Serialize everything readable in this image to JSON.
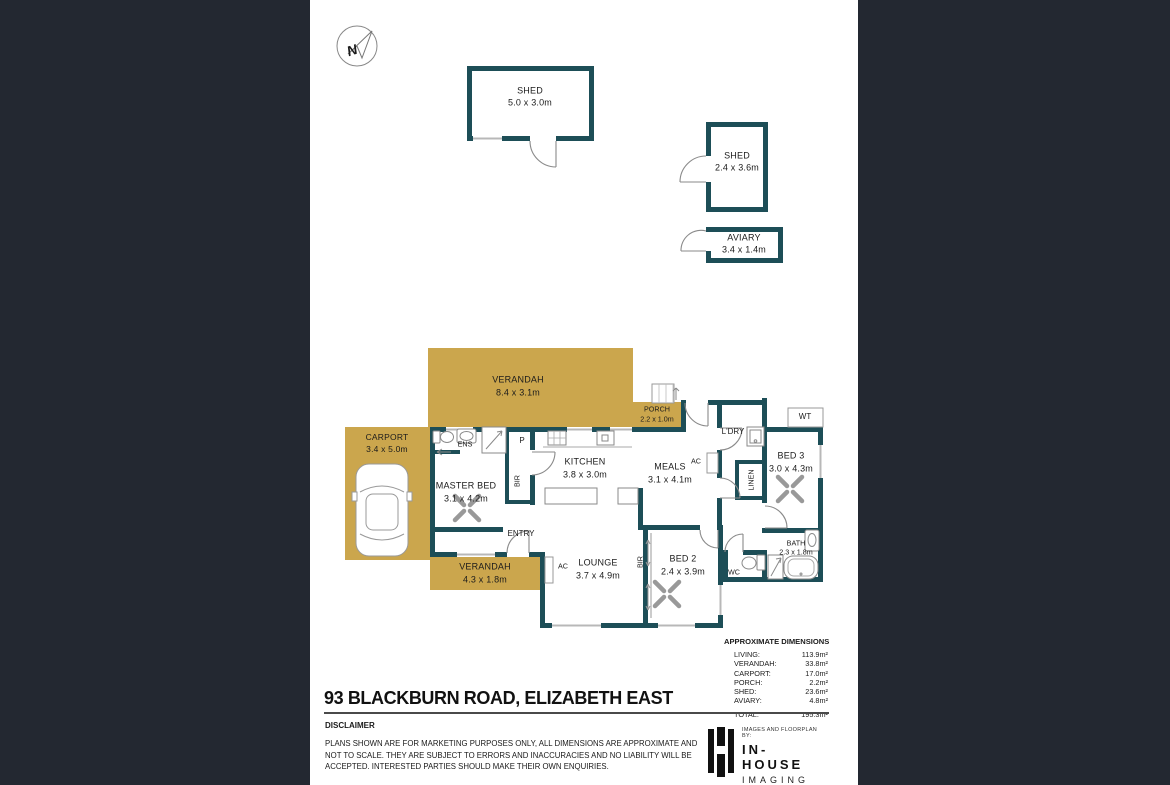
{
  "colors": {
    "background": "#232831",
    "paper": "#ffffff",
    "wall": "#1d4e57",
    "outdoor_gold": "#cba64d"
  },
  "compass": {
    "label": "N"
  },
  "outbuildings": {
    "shed_large": {
      "name": "SHED",
      "dims": "5.0 x 3.0m"
    },
    "shed_small": {
      "name": "SHED",
      "dims": "2.4 x 3.6m"
    },
    "aviary": {
      "name": "AVIARY",
      "dims": "3.4 x 1.4m"
    }
  },
  "rooms": {
    "verandah_top": {
      "name": "VERANDAH",
      "dims": "8.4 x 3.1m"
    },
    "porch": {
      "name": "PORCH",
      "dims": "2.2 x 1.0m"
    },
    "carport": {
      "name": "CARPORT",
      "dims": "3.4 x 5.0m"
    },
    "master_bed": {
      "name": "MASTER BED",
      "dims": "3.1 x 4.2m"
    },
    "ens": {
      "name": "ENS"
    },
    "pantry": {
      "name": "P"
    },
    "bir_master": {
      "name": "BIR"
    },
    "kitchen": {
      "name": "KITCHEN",
      "dims": "3.8 x 3.0m"
    },
    "meals": {
      "name": "MEALS",
      "dims": "3.1 x 4.1m"
    },
    "ac_meals": {
      "name": "AC"
    },
    "ldry": {
      "name": "L'DRY"
    },
    "linen": {
      "name": "LINEN"
    },
    "bed3": {
      "name": "BED 3",
      "dims": "3.0 x 4.3m"
    },
    "wt": {
      "name": "WT"
    },
    "entry": {
      "name": "ENTRY"
    },
    "verandah_bottom": {
      "name": "VERANDAH",
      "dims": "4.3 x 1.8m"
    },
    "ac_lounge": {
      "name": "AC"
    },
    "lounge": {
      "name": "LOUNGE",
      "dims": "3.7 x 4.9m"
    },
    "bir_bed2": {
      "name": "BIR"
    },
    "bed2": {
      "name": "BED 2",
      "dims": "2.4 x 3.9m"
    },
    "wc": {
      "name": "WC"
    },
    "bath": {
      "name": "BATH",
      "dims": "2.3 x 1.8m"
    }
  },
  "summary": {
    "title": "APPROXIMATE DIMENSIONS",
    "rows": [
      {
        "label": "LIVING:",
        "value": "113.9m²"
      },
      {
        "label": "VERANDAH:",
        "value": "33.8m²"
      },
      {
        "label": "CARPORT:",
        "value": "17.0m²"
      },
      {
        "label": "PORCH:",
        "value": "2.2m²"
      },
      {
        "label": "SHED:",
        "value": "23.6m²"
      },
      {
        "label": "AVIARY:",
        "value": "4.8m²"
      }
    ],
    "total": {
      "label": "TOTAL:",
      "value": "195.3m²"
    }
  },
  "address": "93 BLACKBURN ROAD, ELIZABETH EAST",
  "disclaimer": {
    "title": "DISCLAIMER",
    "lines": [
      "PLANS SHOWN ARE FOR MARKETING PURPOSES ONLY, ALL DIMENSIONS ARE APPROXIMATE AND",
      "NOT TO SCALE. THEY ARE SUBJECT TO ERRORS AND INACCURACIES AND NO LIABILITY WILL BE",
      "ACCEPTED. INTERESTED PARTIES SHOULD MAKE THEIR OWN ENQUIRIES."
    ]
  },
  "branding": {
    "tagline": "IMAGES AND FLOORPLAN BY:",
    "name": "IN-HOUSE",
    "name2": "IMAGING",
    "website": "inhouseimaging.com.au"
  }
}
